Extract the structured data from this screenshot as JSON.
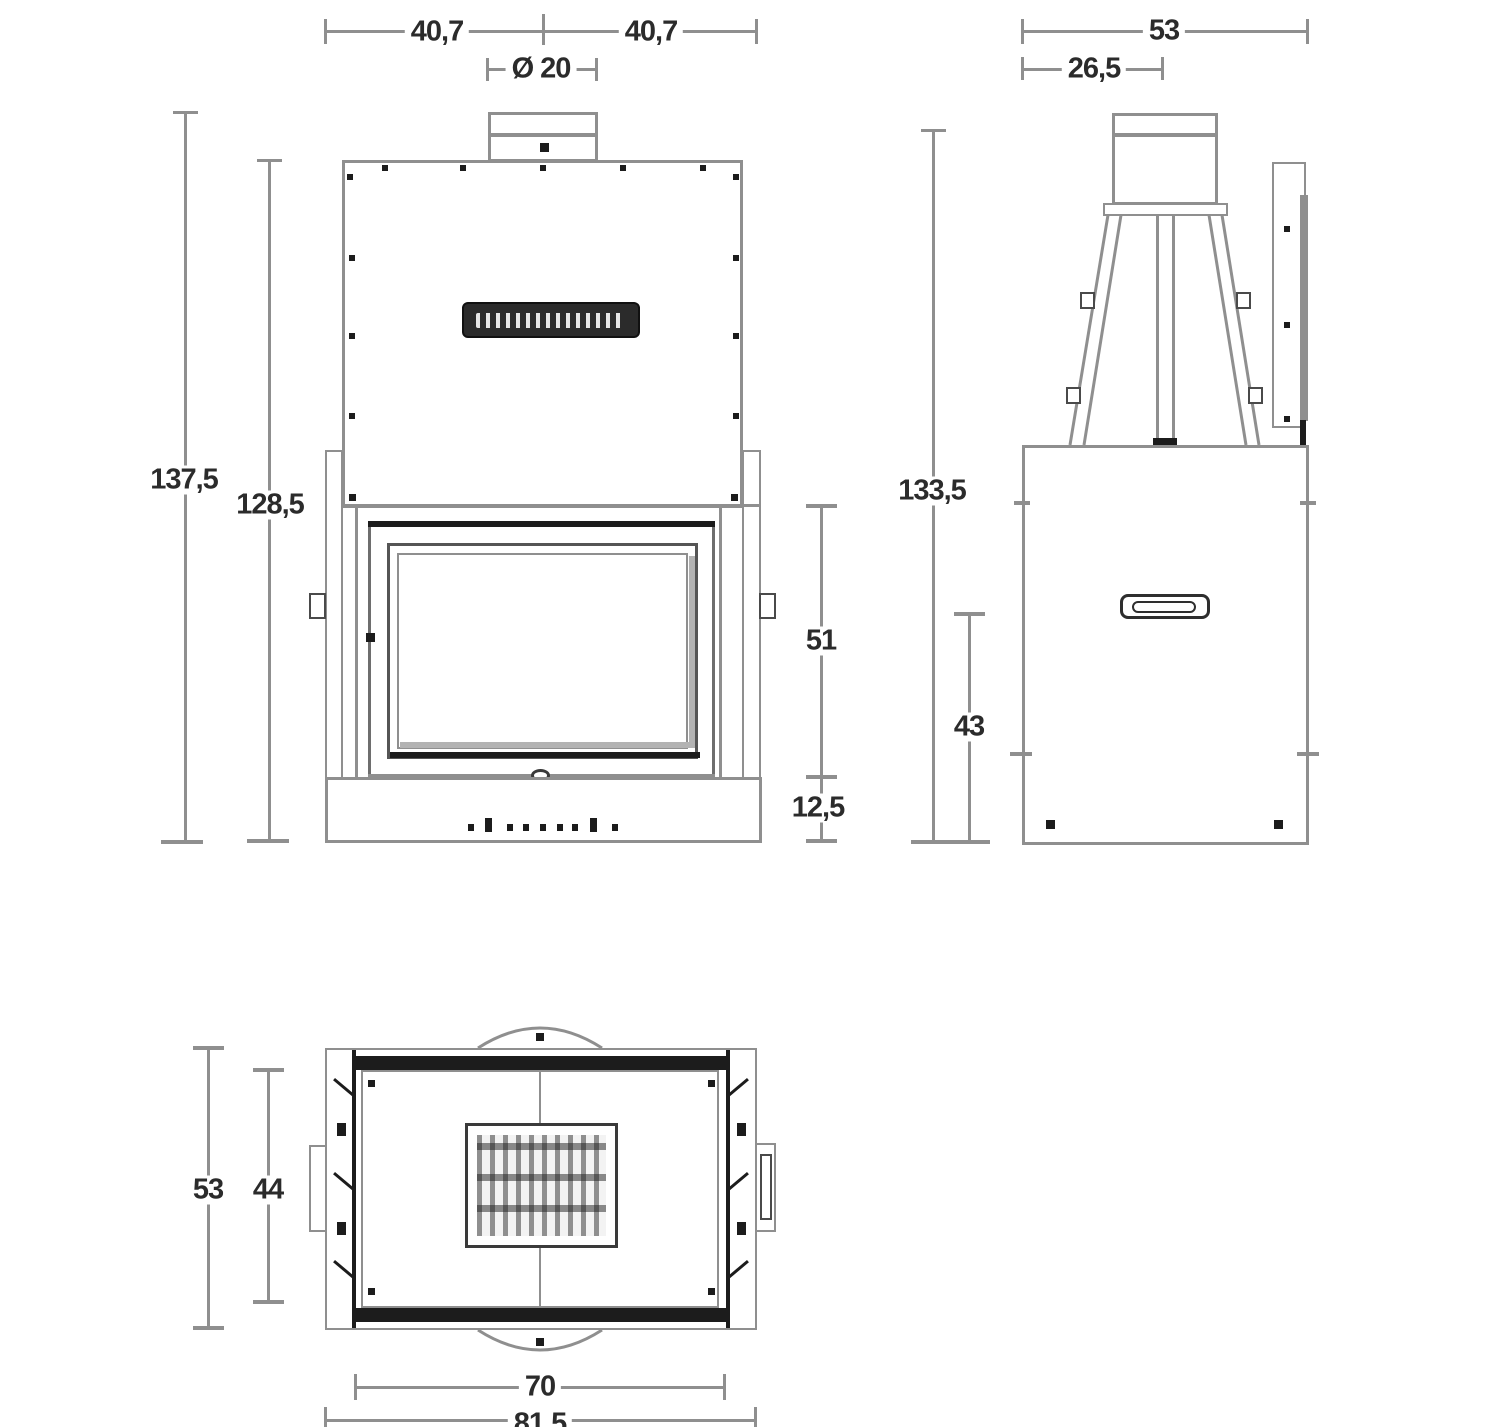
{
  "drawing_title": "fireplace-insert-technical-drawing",
  "views": {
    "front": {
      "name": "front-view",
      "dims": {
        "half_width_left": "40,7",
        "half_width_right": "40,7",
        "flue_diameter": "Ø 20",
        "overall_height": "137,5",
        "hood_height": "128,5",
        "door_height": "51",
        "plinth_height": "12,5"
      }
    },
    "side": {
      "name": "side-view",
      "dims": {
        "overall_depth": "53",
        "flue_axis_offset": "26,5",
        "overall_height": "133,5",
        "body_height": "43"
      }
    },
    "top": {
      "name": "top-view",
      "dims": {
        "overall_depth": "53",
        "inner_depth": "44",
        "inner_width": "70",
        "overall_width": "81,5"
      }
    }
  },
  "icons": {
    "brand_plate": "dark nameplate with illegible white brand lettering"
  },
  "colors": {
    "line_gray": "#8f8f8f",
    "accent_black": "#1c1c1c",
    "background": "#ffffff",
    "text": "#2b2b2b"
  }
}
